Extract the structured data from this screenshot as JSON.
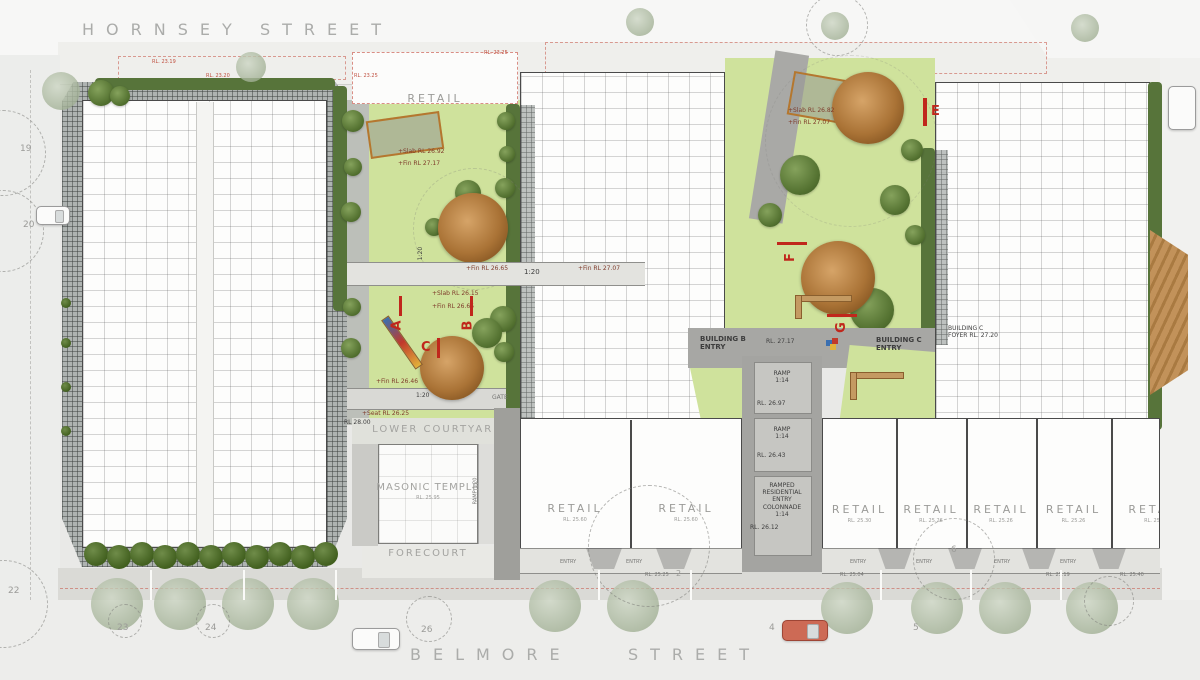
{
  "streets": {
    "top_name": "HORNSEY",
    "top_type": "STREET",
    "bottom_name": "BELMORE",
    "bottom_type": "STREET"
  },
  "places": {
    "retail_top": "RETAIL",
    "lower_courtyard": "LOWER COURTYARD",
    "masonic_temple": "MASONIC TEMPLE",
    "masonic_rl": "RL. 25.95",
    "forecourt": "FORECOURT",
    "mail_room": "MAIL ROOM",
    "gate": "GATE",
    "entry": "ENTRY"
  },
  "buildings": {
    "b_name": "BUILDING B",
    "b_entry": "ENTRY",
    "b_rl": "RL. 27.17",
    "c_name": "BUILDING C",
    "c_entry": "ENTRY",
    "c_foyer_name": "BUILDING C",
    "c_foyer_rl": "FOYER RL. 27.20"
  },
  "ramps": {
    "ramp": "RAMP",
    "grade_114": "1:14",
    "grade_120": "1:20",
    "ramp_side": "RAMP 1:20",
    "colonnade_l1": "RAMPED",
    "colonnade_l2": "RESIDENTIAL",
    "colonnade_l3": "ENTRY",
    "colonnade_l4": "COLONNADE"
  },
  "levels": {
    "rl_2319": "RL. 23.19",
    "rl_2320": "RL. 23.20",
    "rl_2325": "RL. 23.25",
    "slab_2692": "+Slab RL 26.92",
    "fin_2717": "+Fin RL 27.17",
    "slab_2615": "+Slab RL 26.15",
    "fin_2665": "+Fin RL 26.65",
    "fin_2707": "+Fin RL 27.07",
    "slab_2682": "+Slab RL 26.82",
    "fin_2707b": "+Fin RL 27.07",
    "fin_2646": "+Fin RL 26.46",
    "seat_2625": "+Seat RL 26.25",
    "rl_2800": "RL 28.00",
    "rl_2697": "RL. 26.97",
    "rl_2643": "RL. 26.43",
    "rl_2612": "RL. 26.12",
    "rl_2525": "RL. 25.25",
    "rl_2504": "RL. 25.04",
    "rl_2519": "RL. 25.19",
    "rl_2540": "RL. 25.40"
  },
  "retail": {
    "label": "RETAIL",
    "left_rl_1": "RL. 25.60",
    "left_rl_2": "RL. 25.60",
    "right_rl_1": "RL. 25.30",
    "right_rl_2": "RL. 25.26",
    "right_rl_3": "RL. 25.26",
    "right_rl_4": "RL. 25.26",
    "right_rl_5": "RL. 25.26"
  },
  "markers": {
    "a": "A",
    "b": "B",
    "c": "C",
    "e": "E",
    "f": "F",
    "g": "G"
  },
  "lots": {
    "n19": "19",
    "n20": "20",
    "n22": "22",
    "n23": "23",
    "n24": "24",
    "n26": "26",
    "n2": "2",
    "n4": "4",
    "n5": "5",
    "n6": "6"
  },
  "colors": {
    "marker_red": "#c0271c",
    "grass_green": "#cfe29c",
    "hedge_green": "#4f6c33",
    "roof_gray": "#aeb3b1",
    "tan_timber": "#b98a4e"
  }
}
